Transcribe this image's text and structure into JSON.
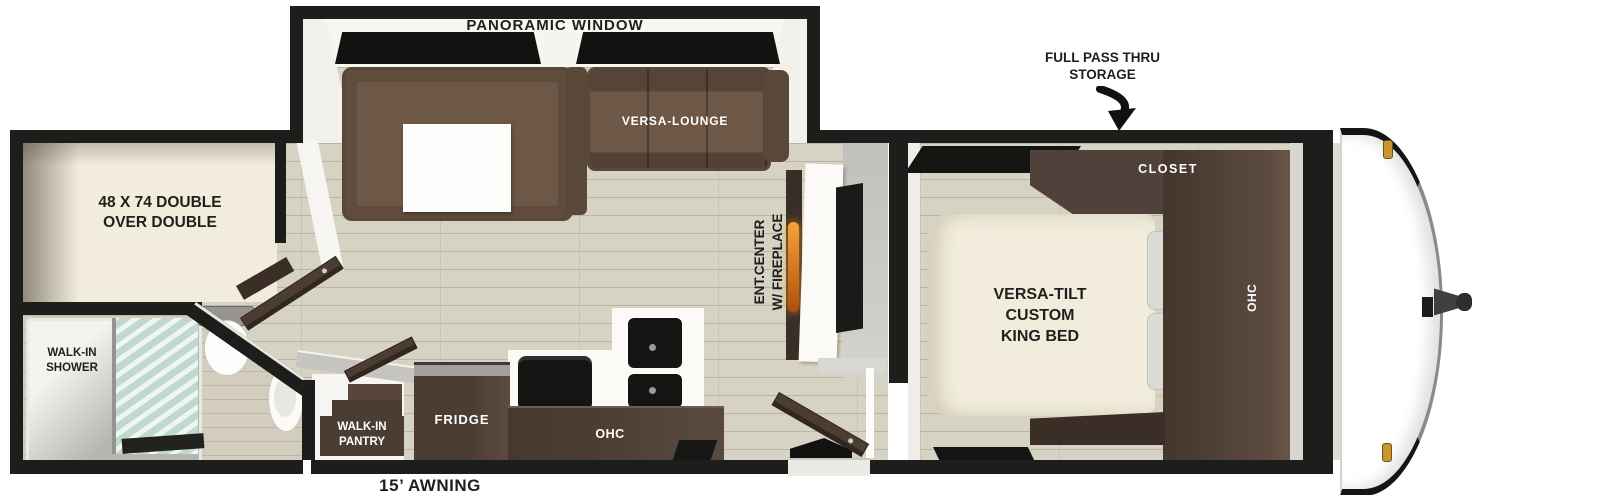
{
  "colors": {
    "wall": "#1d1d1b",
    "floor": "#d7d3c4",
    "sofa": "#6d5746",
    "sofa_dark": "#594837",
    "cabinet": "#4c3d33",
    "cabinet_dark": "#3a2e26",
    "cabinet_light": "#6a574a",
    "mattress": "#f1ecdb",
    "pillow": "#dcdcd6",
    "white_surface": "#fbfaf7",
    "gray_wall": "#c8c6c0",
    "glass_a": "#eef6f2",
    "glass_b": "#bfd8d0",
    "black_fixture": "#141412",
    "flame_a": "#f7a33b",
    "flame_b": "#b04e0d",
    "amber": "#c9962e",
    "label_dark": "#1f1f1d",
    "label_light": "#ffffff"
  },
  "exterior": {
    "pass_thru_line1": "FULL PASS THRU",
    "pass_thru_line2": "STORAGE",
    "awning": "15’ AWNING"
  },
  "living": {
    "panoramic_window": "PANORAMIC WINDOW",
    "versa_lounge": "VERSA-LOUNGE",
    "ent_center_line1": "ENT.CENTER",
    "ent_center_line2": "W/ FIREPLACE"
  },
  "kitchen": {
    "fridge": "FRIDGE",
    "ohc": "OHC",
    "pantry_line1": "WALK-IN",
    "pantry_line2": "PANTRY"
  },
  "bedroom": {
    "bed_line1": "VERSA-TILT",
    "bed_line2": "CUSTOM",
    "bed_line3": "KING BED",
    "closet": "CLOSET",
    "ohc": "OHC"
  },
  "rear": {
    "bunk_line1": "48 X 74 DOUBLE",
    "bunk_line2": "OVER DOUBLE",
    "shower_line1": "WALK-IN",
    "shower_line2": "SHOWER"
  }
}
